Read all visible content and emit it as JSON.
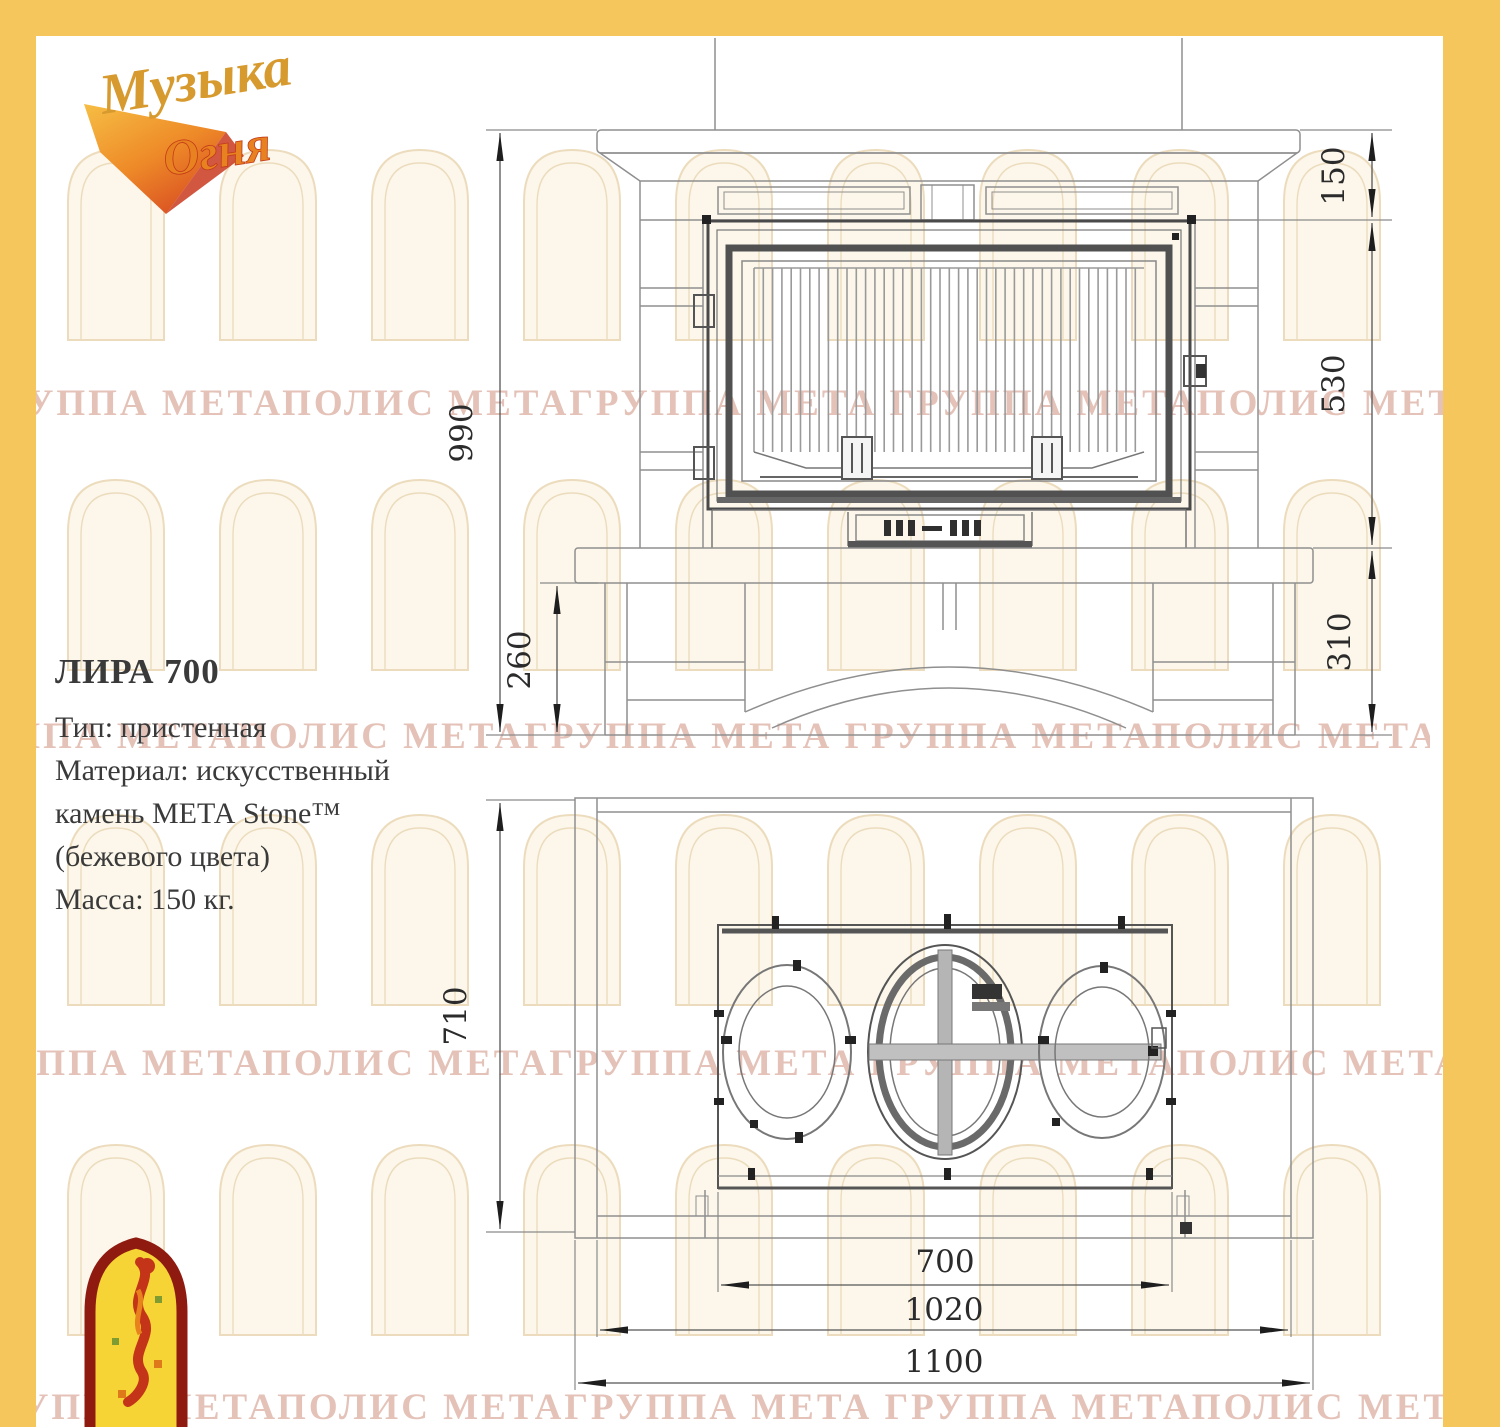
{
  "colors": {
    "page_border": "#F4C65C",
    "stone_line": "#8f8f8f",
    "firebox_line": "#4a4a4a",
    "dim_line": "#8a8a8a",
    "dim_text": "#2b2b2b",
    "watermark_text": "#e4c2b8",
    "arch_fill": "#fcf7ea",
    "arch_stroke": "#ecdcbd",
    "badge_fill": "#F6D435",
    "badge_border": "#8F1B10",
    "logo_gold": "#D79A2E",
    "logo_orange": "#E8811F"
  },
  "brand": {
    "name_line1": "Музыка",
    "name_line2": "Огня"
  },
  "watermark": {
    "phrase": "ГРУППА МЕТАПОЛИС МЕТАГРУППА МЕТА",
    "repeat": 3
  },
  "product": {
    "name": "ЛИРА 700",
    "lines": [
      "Тип: пристенная",
      "Материал: искусственный",
      "камень МЕТА Stone™",
      "(бежевого цвета)",
      "Масса: 150 кг."
    ]
  },
  "front_view": {
    "dims": {
      "total_height": "990",
      "mantel_height": "150",
      "firebox_height": "530",
      "hearth_to_floor": "310",
      "base_height": "260"
    }
  },
  "plan_view": {
    "dims": {
      "depth": "710",
      "firebox_width": "700",
      "inner_width": "1020",
      "total_width": "1100"
    }
  }
}
